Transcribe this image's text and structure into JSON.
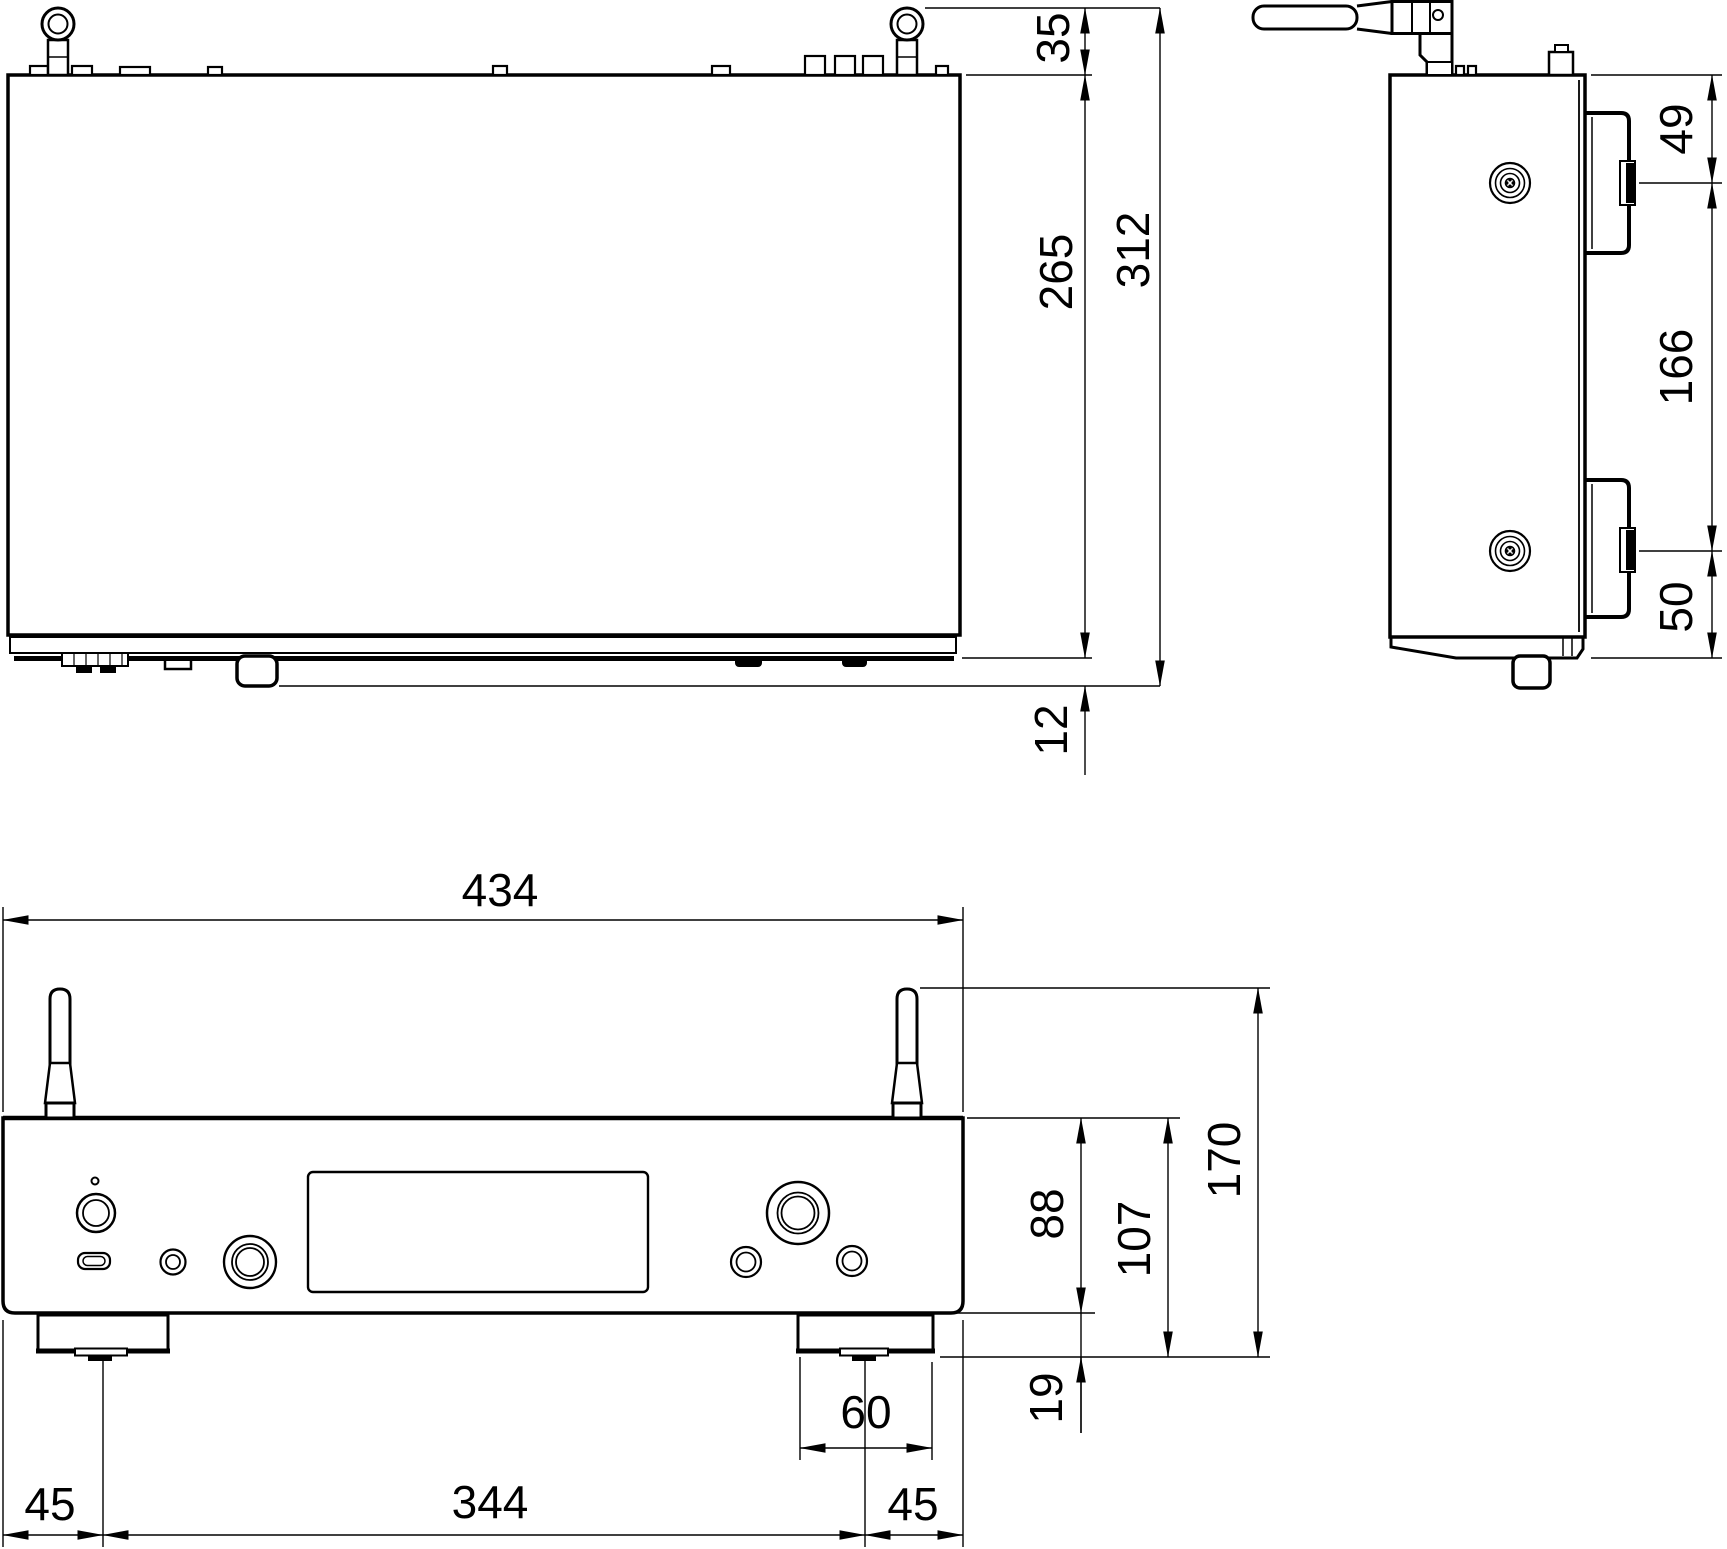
{
  "document": {
    "title": "Dimensional outline drawing, three orthographic views",
    "unit": "mm",
    "background_color": "#ffffff",
    "line_color": "#000000"
  },
  "views": {
    "top": {
      "label": "Top view",
      "dims": {
        "d35": "35",
        "d265": "265",
        "d312": "312",
        "d12": "12"
      }
    },
    "side": {
      "label": "Side view",
      "dims": {
        "d49": "49",
        "d166": "166",
        "d50": "50"
      }
    },
    "front": {
      "label": "Front view",
      "dims": {
        "d434": "434",
        "d88": "88",
        "d107": "107",
        "d170": "170",
        "d19": "19",
        "d60": "60",
        "d45_left": "45",
        "d344": "344",
        "d45_right": "45"
      }
    }
  }
}
